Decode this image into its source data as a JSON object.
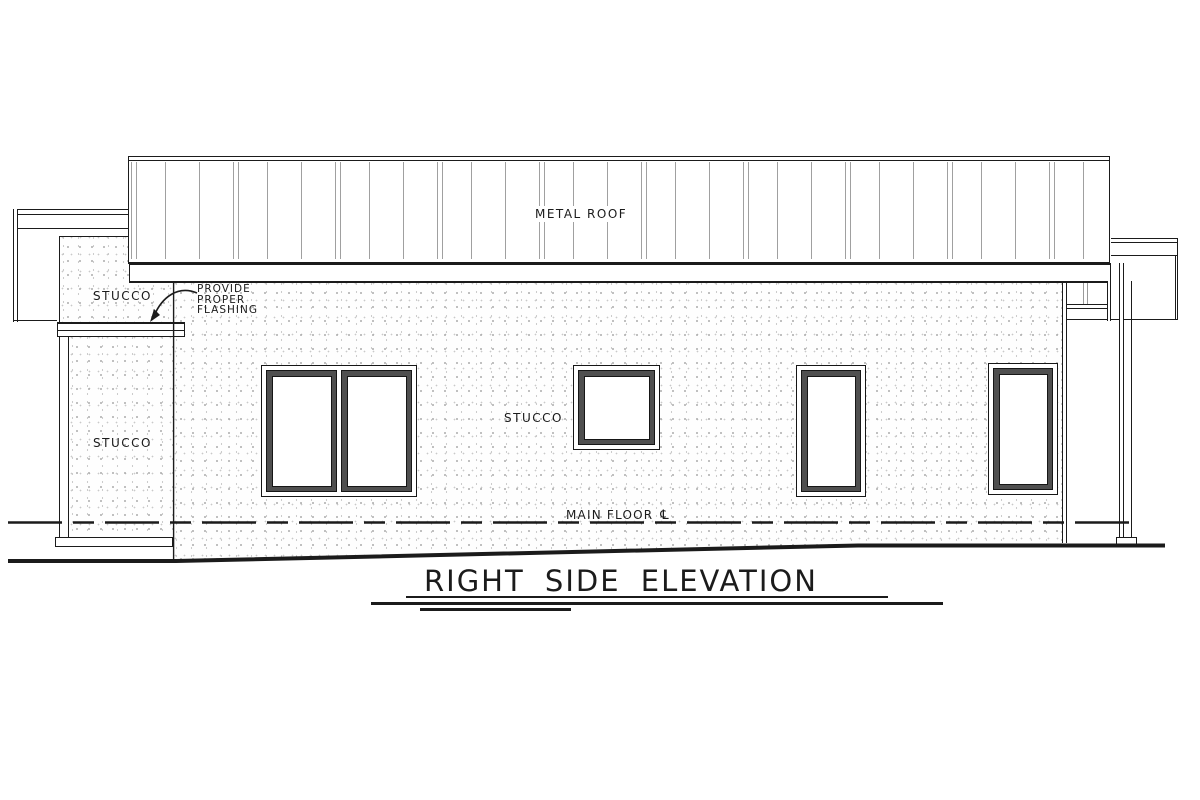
{
  "drawing_title": {
    "text": "RIGHT SIDE ELEVATION"
  },
  "roof": {
    "label": "METAL ROOF"
  },
  "wall_labels": {
    "upper_stucco": "STUCCO",
    "column_stucco": "STUCCO",
    "main_stucco": "STUCCO"
  },
  "flashing_note": {
    "line1": "PROVIDE",
    "line2": "PROPER",
    "line3": "FLASHING"
  },
  "floor_line": {
    "label": "MAIN FLOOR",
    "datum_symbol": "℄"
  },
  "colors": {
    "line": "#1b1b1b",
    "roof_seam": "#a0a0a0",
    "window_frame": "#4f4f4f",
    "stucco_dot": "#b3b3b3",
    "background": "#ffffff"
  }
}
